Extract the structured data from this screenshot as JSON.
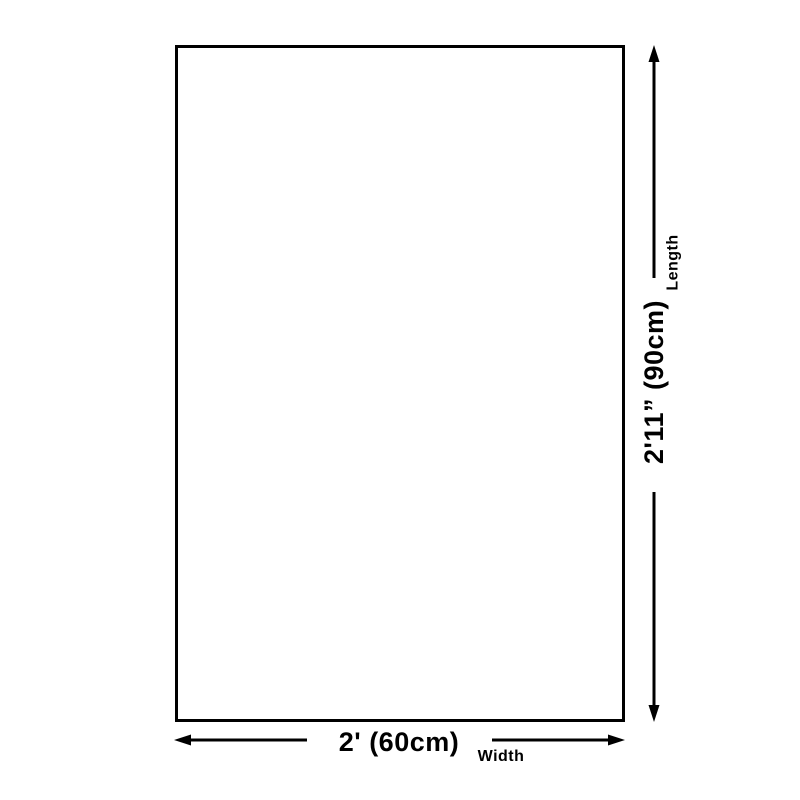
{
  "diagram": {
    "length": {
      "label": "Length",
      "value": "2'11” (90cm)"
    },
    "width": {
      "label": "Width",
      "value": "2' (60cm)"
    },
    "colors": {
      "foreground": "#000000",
      "background": "#ffffff",
      "shape_fill": "#ffffff"
    }
  }
}
